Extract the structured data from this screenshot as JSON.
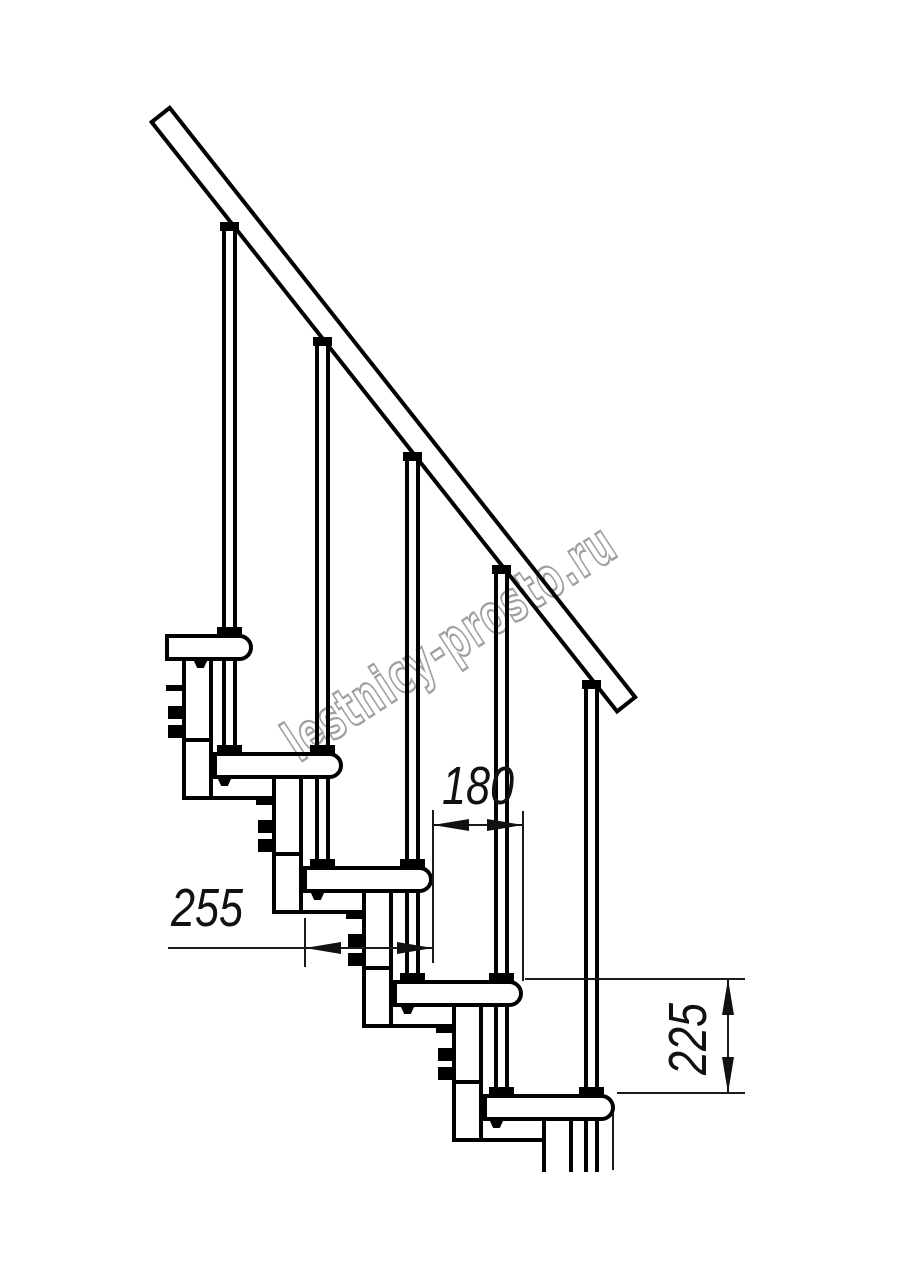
{
  "drawing": {
    "title": "modular-staircase-side-view",
    "watermark": "lestnicy-prosto.ru",
    "dimensions": {
      "step_run": "180",
      "tread_depth": "255",
      "riser_height": "225"
    },
    "colors": {
      "line": "#000000",
      "dim_line": "#111111",
      "watermark": "#9f9f9f",
      "background": "#ffffff"
    }
  }
}
